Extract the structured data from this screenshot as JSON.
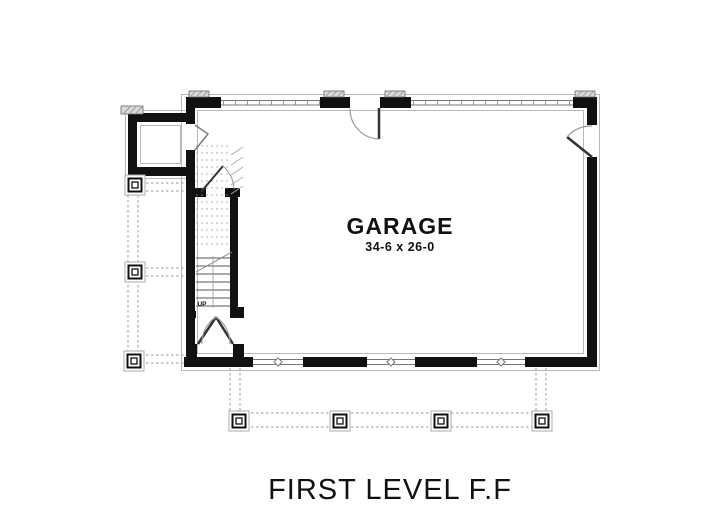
{
  "title": "FIRST LEVEL F.F",
  "room": {
    "name": "GARAGE",
    "dimensions": "34-6 x 26-0"
  },
  "stairs": {
    "up_label": "UP"
  },
  "colors": {
    "wall": "#111111",
    "thin_line": "#777777",
    "swing_arc": "#999999",
    "dashed_line": "#999999",
    "hatch_fill": "#d9d9d9",
    "background": "#ffffff",
    "text": "#111111"
  }
}
